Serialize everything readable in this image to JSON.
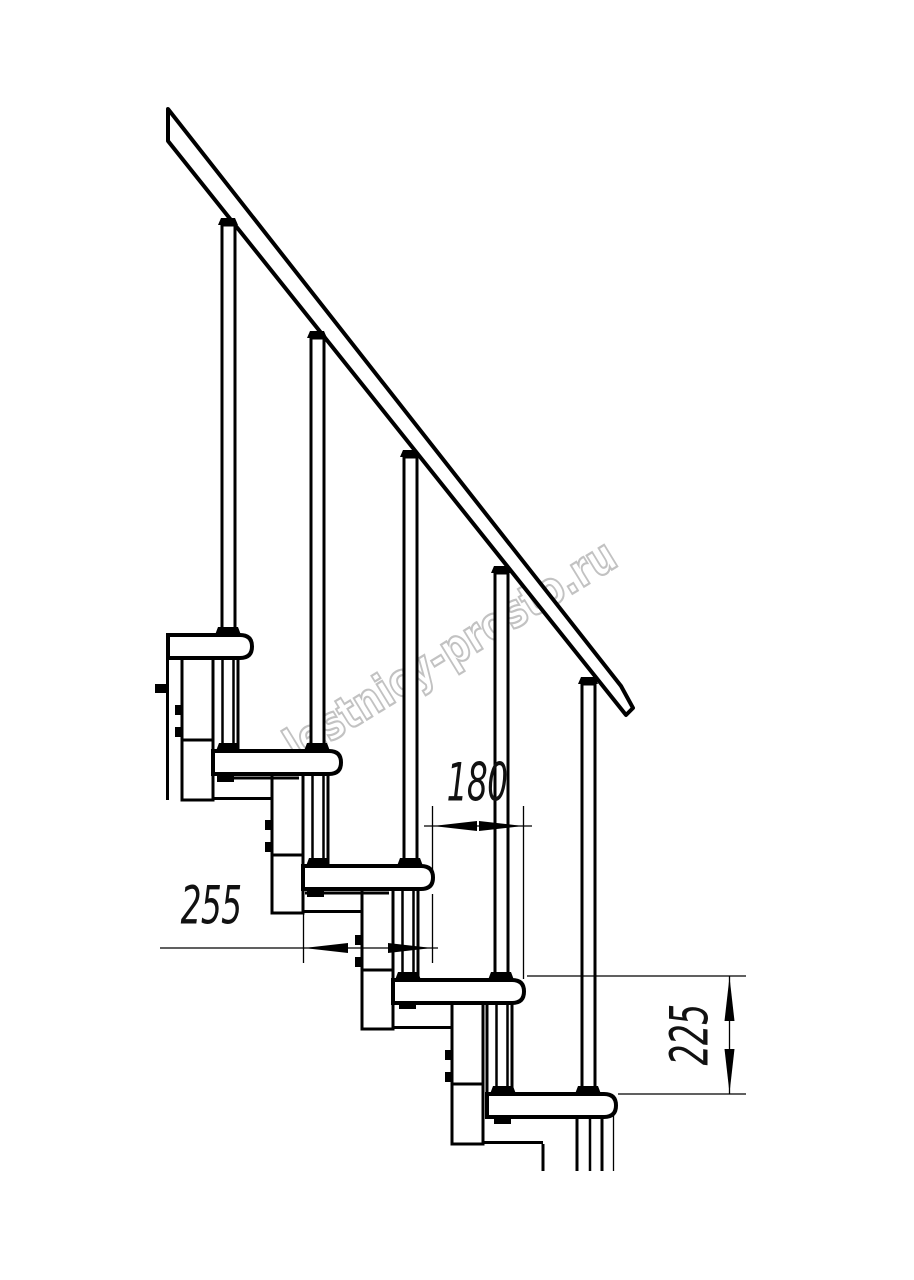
{
  "drawing": {
    "title": "staircase-side-elevation",
    "dimensions": {
      "step_run": "180",
      "tread_depth": "255",
      "step_rise": "225"
    },
    "watermark": {
      "text": "lestnicy-prosto.ru",
      "color": "#c2c2c2"
    },
    "colors": {
      "line": "#000000",
      "background": "#ffffff"
    }
  }
}
